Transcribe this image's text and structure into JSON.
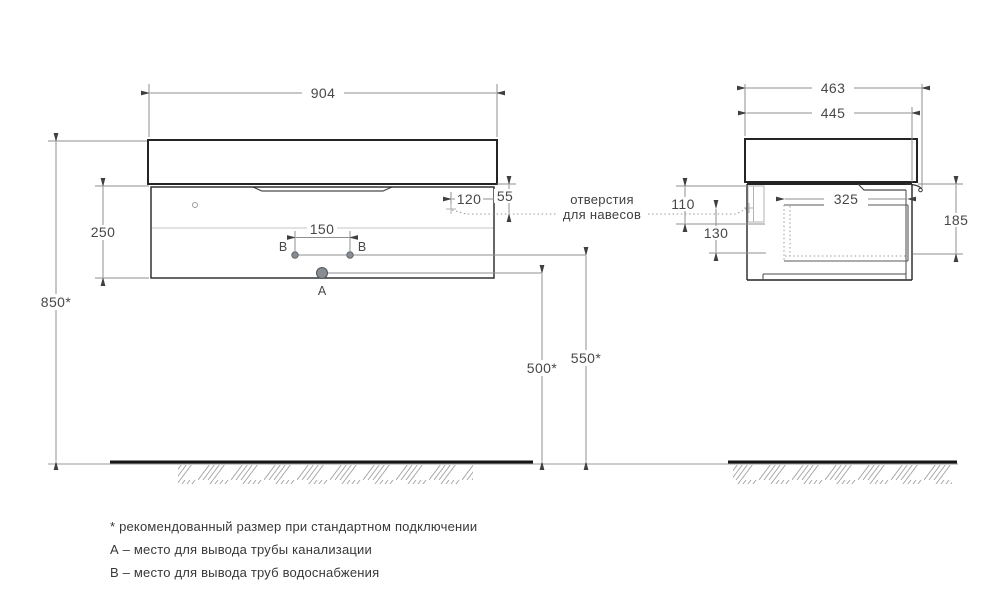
{
  "front_view": {
    "dim_width": "904",
    "dim_body_height": "250",
    "dim_install_height": "850*",
    "dim_hole_inset": "120",
    "dim_hole_drop": "55",
    "dim_water_spacing": "150",
    "label_water_left": "В",
    "label_water_right": "В",
    "label_drain": "А",
    "dim_drain_height": "500*",
    "dim_water_height": "550*"
  },
  "side_view": {
    "dim_depth_total": "463",
    "dim_depth_body": "445",
    "dim_bracket_height": "110",
    "dim_hole_to_bottom": "130",
    "dim_inner_depth": "325",
    "dim_inner_height": "185"
  },
  "callout": {
    "line1": "отверстия",
    "line2": "для навесов"
  },
  "footnotes": [
    "* рекомендованный размер при стандартном подключении",
    "А – место для вывода трубы канализации",
    "В – место для вывода труб водоснабжения"
  ]
}
